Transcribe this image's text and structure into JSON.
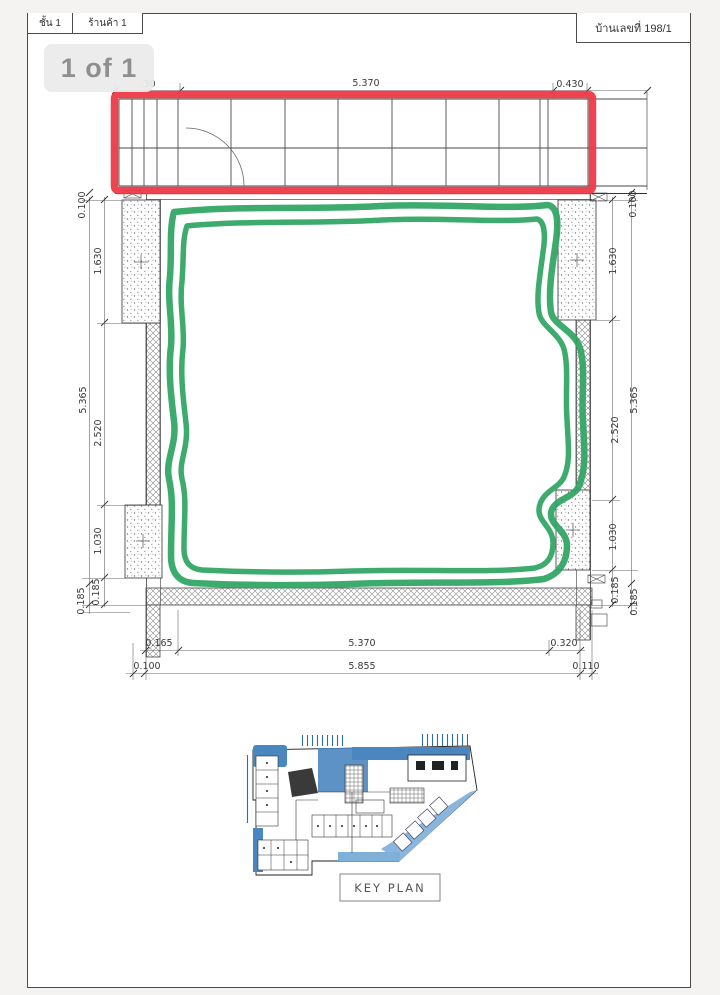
{
  "viewer": {
    "pager_label": "1 of 1"
  },
  "title_bar": {
    "floor": "ชั้น 1",
    "shop": "ร้านค้า 1",
    "house_no": "บ้านเลขที่ 198/1"
  },
  "plan": {
    "dims": {
      "top_left": ".30",
      "top_span": "5.370",
      "top_right": "0.430",
      "left": {
        "wall": "0.100",
        "col_top": "1.630",
        "overall": "5.365",
        "mid": "2.520",
        "col_bottom": "1.030",
        "base_a": "0.185",
        "base_b": "0.185"
      },
      "right": {
        "wall": "0.100",
        "col_top": "1.630",
        "overall": "5.365",
        "mid": "2.520",
        "col_bottom": "1.030",
        "base_a": "0.185",
        "base_b": "0.185"
      },
      "bottom": {
        "left_offset": "0.165",
        "span_inner": "5.370",
        "right_offset": "0.320",
        "left_edge": "0.100",
        "span_outer": "5.855",
        "right_edge": "0.110"
      }
    },
    "annotation_colors": {
      "highlight_red": "#ee3a46",
      "marker_green": "#2fa563"
    }
  },
  "key_plan": {
    "label": "KEY PLAN",
    "accent_blue": "#4a86c0"
  }
}
